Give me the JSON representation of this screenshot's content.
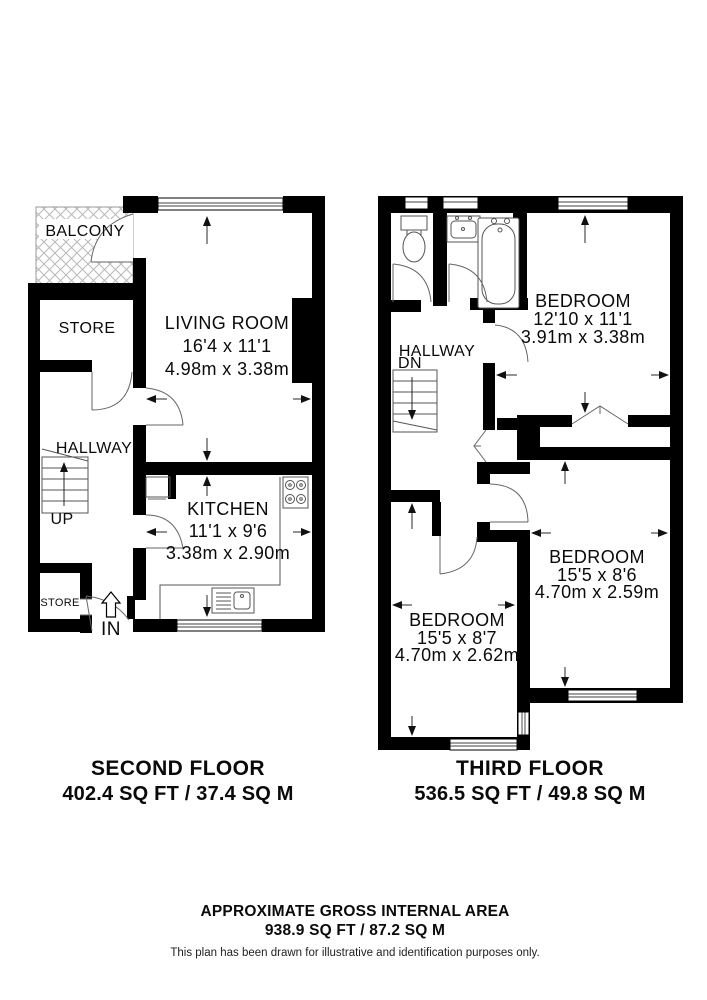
{
  "second": {
    "title": "SECOND FLOOR",
    "area": "402.4 SQ FT / 37.4 SQ M",
    "balcony": "BALCONY",
    "store": "STORE",
    "store_small": "STORE",
    "hallway": "HALLWAY",
    "up": "UP",
    "in_label": "IN",
    "living": {
      "name": "LIVING ROOM",
      "imperial": "16'4 x 11'1",
      "metric": "4.98m x 3.38m"
    },
    "kitchen": {
      "name": "KITCHEN",
      "imperial": "11'1 x 9'6",
      "metric": "3.38m x 2.90m"
    }
  },
  "third": {
    "title": "THIRD FLOOR",
    "area": "536.5 SQ FT / 49.8 SQ M",
    "hallway": "HALLWAY",
    "dn": "DN",
    "bedroom1": {
      "name": "BEDROOM",
      "imperial": "12'10 x 11'1",
      "metric": "3.91m x 3.38m"
    },
    "bedroom2": {
      "name": "BEDROOM",
      "imperial": "15'5 x 8'6",
      "metric": "4.70m x 2.59m"
    },
    "bedroom3": {
      "name": "BEDROOM",
      "imperial": "15'5 x 8'7",
      "metric": "4.70m x 2.62m"
    }
  },
  "footer": {
    "title": "APPROXIMATE GROSS INTERNAL AREA",
    "area": "938.9 SQ FT / 87.2 SQ M",
    "disclaimer": "This plan has been drawn for illustrative and identification purposes only."
  },
  "colors": {
    "wall": "#000000",
    "background": "#ffffff"
  }
}
